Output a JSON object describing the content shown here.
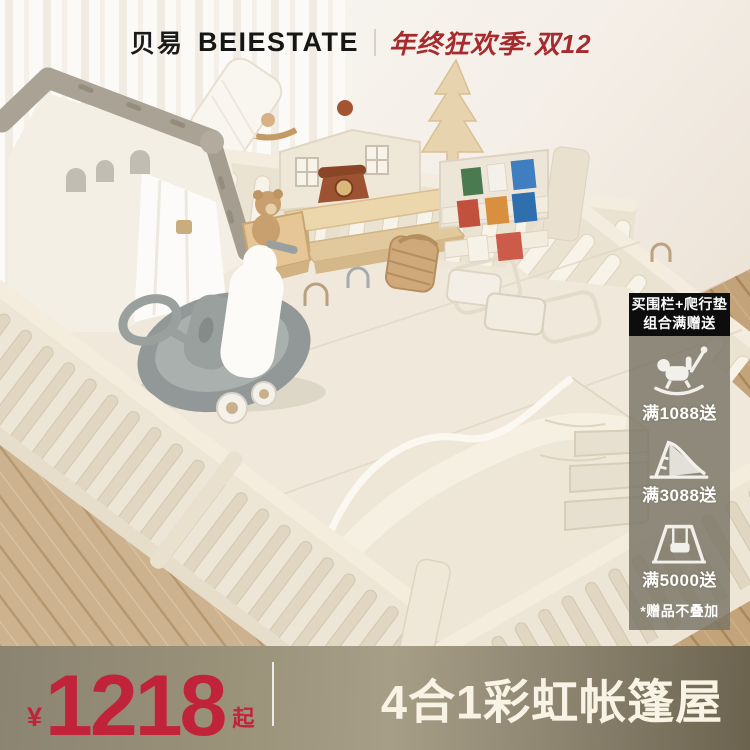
{
  "header": {
    "brand_cn": "贝易",
    "brand_en": "BEIESTATE",
    "divider": "|",
    "promo": "年终狂欢季·双12"
  },
  "gifts": {
    "banner_line1": "买围栏+爬行垫",
    "banner_line2": "组合满赠送",
    "tiers": [
      {
        "icon": "rocking-horse-gift",
        "label": "满1088送"
      },
      {
        "icon": "toddler-slide-gift",
        "label": "满3088送"
      },
      {
        "icon": "baby-swing-gift",
        "label": "满5000送"
      }
    ],
    "note": "*赠品不叠加"
  },
  "footer": {
    "currency": "¥",
    "price": "1218",
    "price_suffix": "起",
    "product_name": "4合1彩虹帐篷屋"
  },
  "colors": {
    "accent_red": "#c0233a",
    "promo_red": "#a62b2e",
    "banner_black": "#0d0d0d",
    "panel_overlay": "rgba(122,117,102,0.83)",
    "bar_olive": "#8f8773",
    "playpen_cream": "#ece4d4",
    "name_text": "#f8f3e4"
  }
}
